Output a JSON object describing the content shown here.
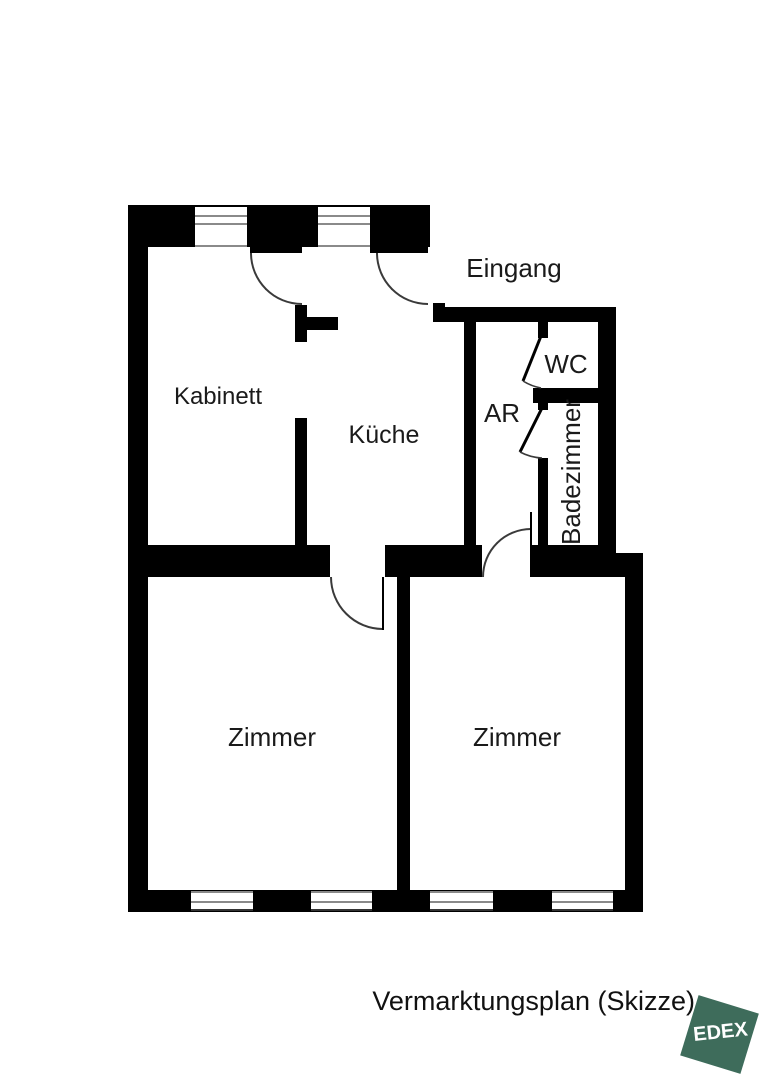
{
  "plan_type": "floorplan",
  "caption": "Vermarktungsplan (Skizze)",
  "logo": {
    "text": "EDEX",
    "color": "#3E6C5B",
    "shape": "rotated-square"
  },
  "rooms": {
    "eingang": "Eingang",
    "kabinett": "Kabinett",
    "kueche": "Küche",
    "ar": "AR",
    "wc": "WC",
    "badezimmer": "Badezimmer",
    "zimmer_left": "Zimmer",
    "zimmer_right": "Zimmer"
  },
  "colors": {
    "wall": "#000000",
    "door_line": "#3a3a3a",
    "window_line": "#8a8a8a",
    "background": "#ffffff"
  }
}
